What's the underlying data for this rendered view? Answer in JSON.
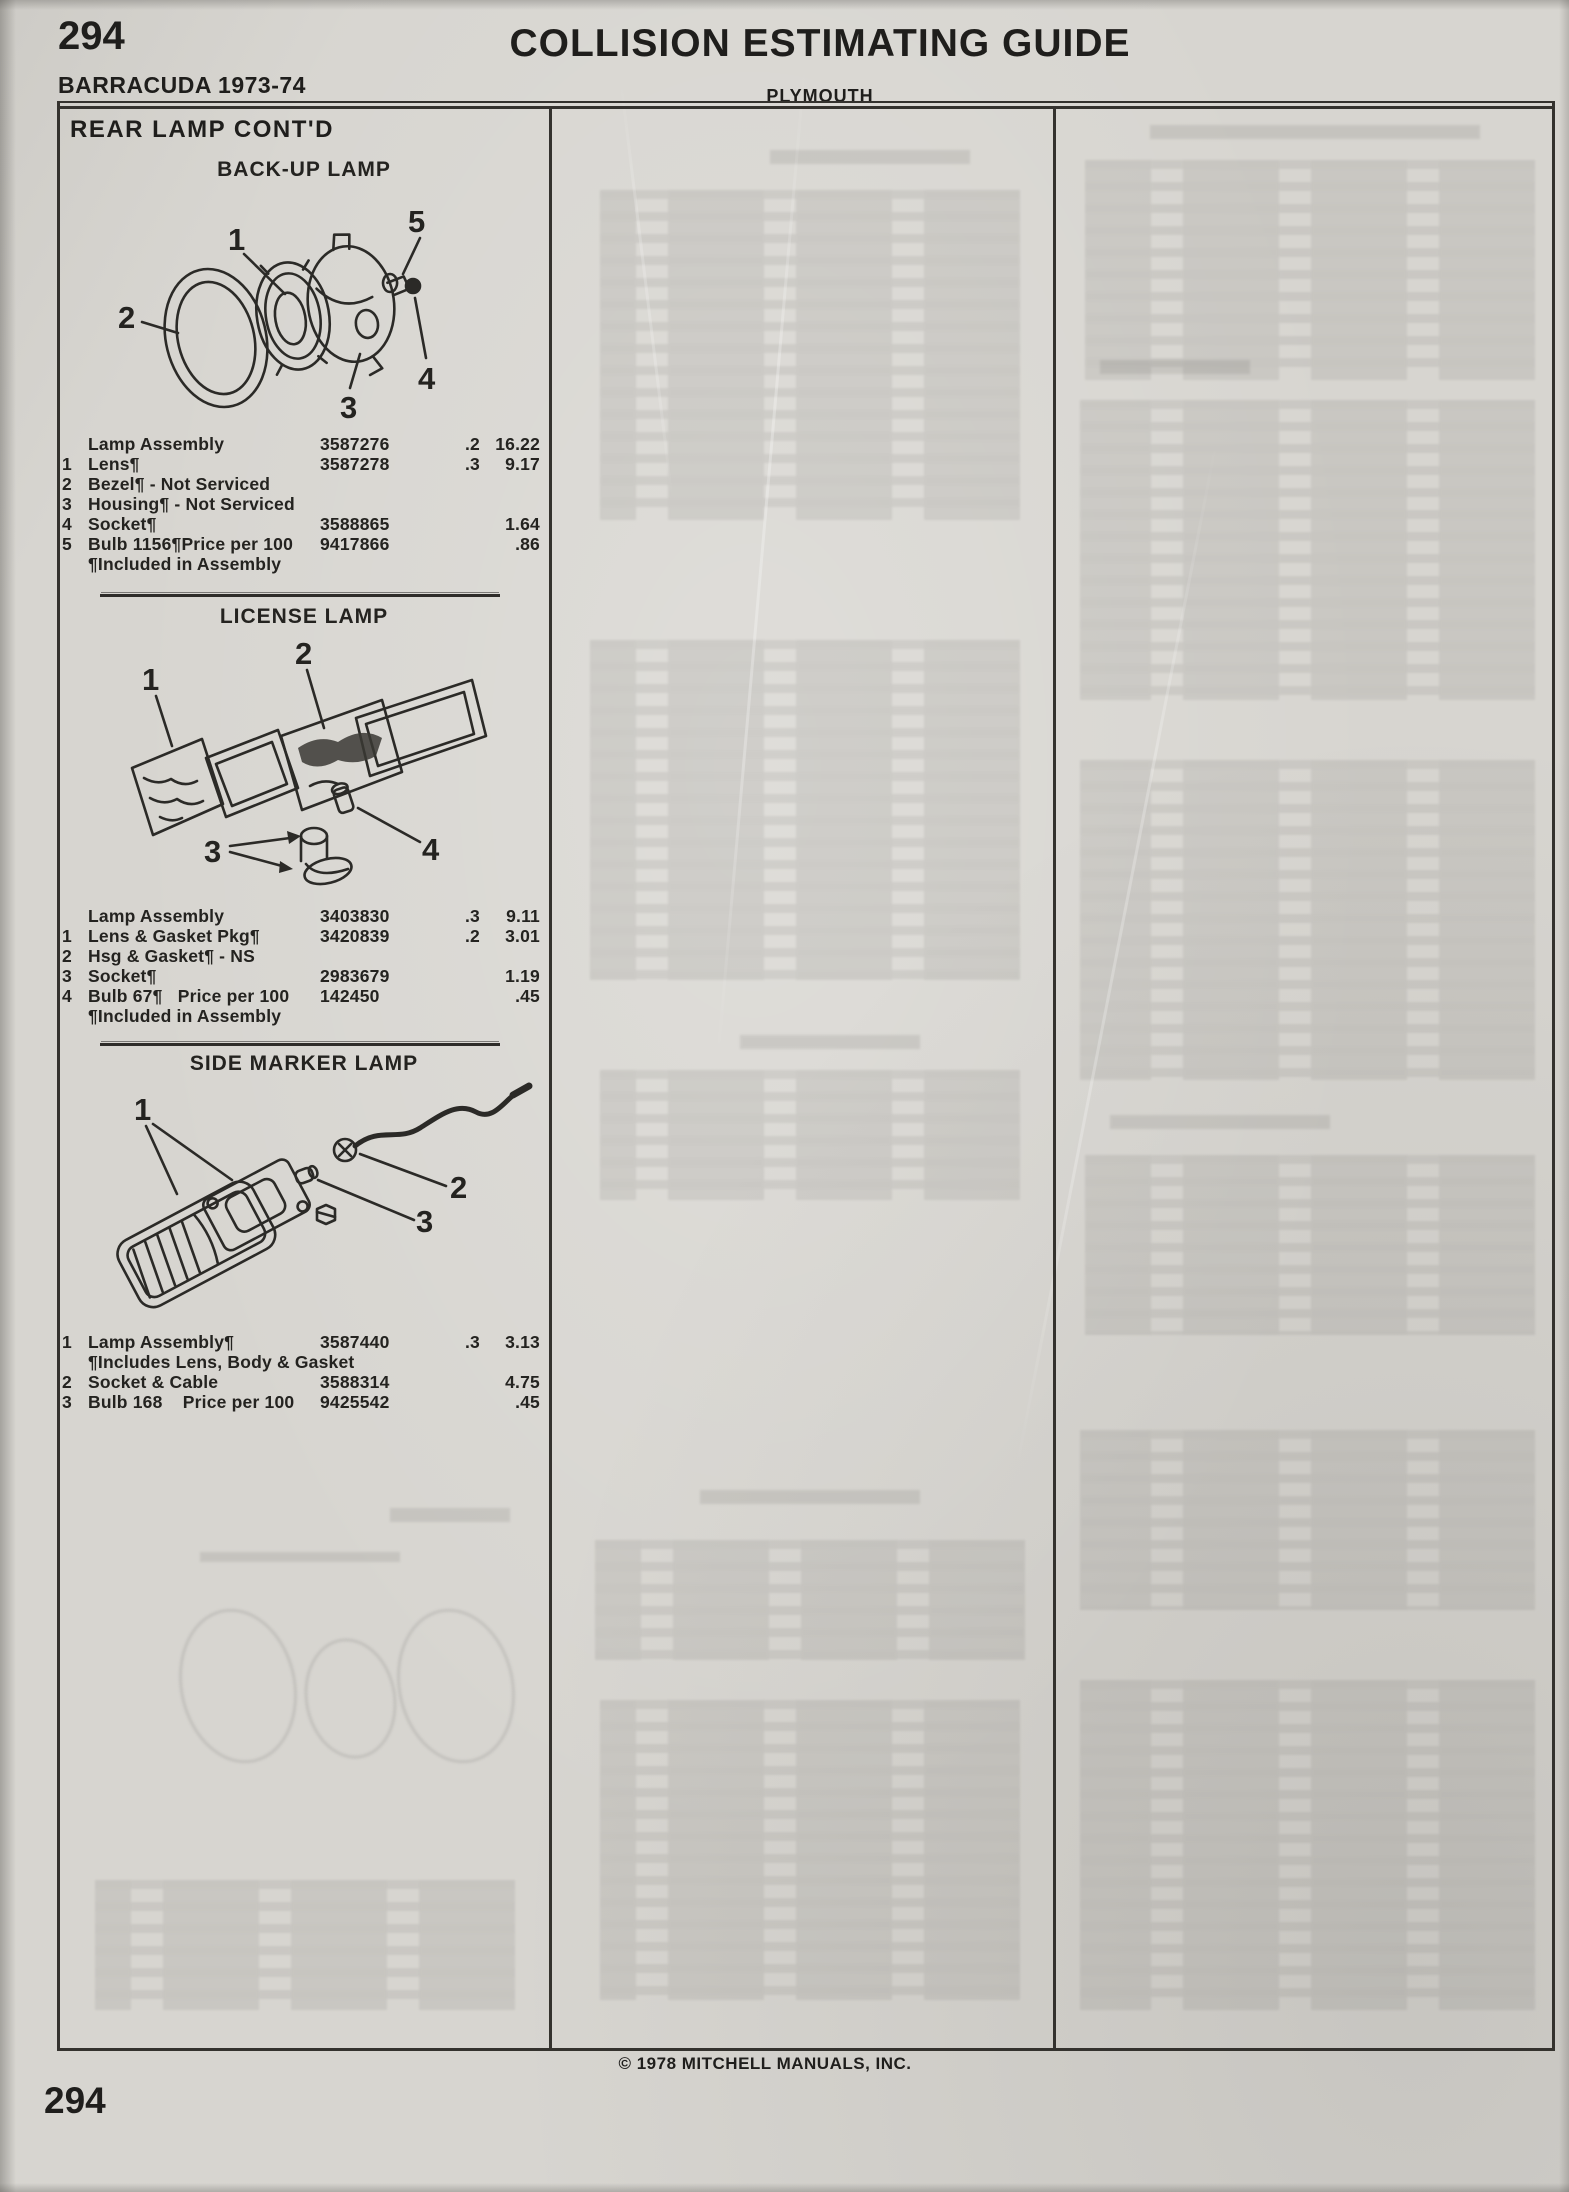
{
  "page": {
    "page_number_top": "294",
    "title": "COLLISION ESTIMATING GUIDE",
    "model": "BARRACUDA 1973-74",
    "make": "PLYMOUTH",
    "column_header": "REAR LAMP CONT'D",
    "copyright": "© 1978 MITCHELL MANUALS, INC.",
    "page_number_bottom": "294"
  },
  "sections": [
    {
      "heading": "BACK-UP LAMP",
      "callouts": [
        "1",
        "2",
        "3",
        "4",
        "5"
      ],
      "rows": [
        [
          "",
          "Lamp Assembly",
          "3587276",
          ".2",
          "16.22"
        ],
        [
          "1",
          "Lens¶",
          "3587278",
          ".3",
          "9.17"
        ],
        [
          "2",
          "Bezel¶ - Not Serviced",
          "",
          "",
          ""
        ],
        [
          "3",
          "Housing¶ - Not Serviced",
          "",
          "",
          ""
        ],
        [
          "4",
          "Socket¶",
          "3588865",
          "",
          "1.64"
        ],
        [
          "5",
          "Bulb 1156¶Price per 100",
          "9417866",
          "",
          ".86"
        ],
        [
          "",
          "¶Included in Assembly",
          "",
          "",
          ""
        ]
      ]
    },
    {
      "heading": "LICENSE LAMP",
      "callouts": [
        "1",
        "2",
        "3",
        "4"
      ],
      "rows": [
        [
          "",
          "Lamp Assembly",
          "3403830",
          ".3",
          "9.11"
        ],
        [
          "1",
          "Lens & Gasket Pkg¶",
          "3420839",
          ".2",
          "3.01"
        ],
        [
          "2",
          "Hsg & Gasket¶ - NS",
          "",
          "",
          ""
        ],
        [
          "3",
          "Socket¶",
          "2983679",
          "",
          "1.19"
        ],
        [
          "4",
          "Bulb 67¶   Price per 100",
          "142450",
          "",
          ".45"
        ],
        [
          "",
          "¶Included in Assembly",
          "",
          "",
          ""
        ]
      ]
    },
    {
      "heading": "SIDE MARKER LAMP",
      "callouts": [
        "1",
        "2",
        "3"
      ],
      "rows": [
        [
          "1",
          "Lamp Assembly¶",
          "3587440",
          ".3",
          "3.13"
        ],
        [
          "",
          "¶Includes Lens, Body & Gasket",
          "",
          "",
          ""
        ],
        [
          "2",
          "Socket & Cable",
          "3588314",
          "",
          "4.75"
        ],
        [
          "3",
          "Bulb 168    Price per 100",
          "9425542",
          "",
          ".45"
        ]
      ]
    }
  ]
}
